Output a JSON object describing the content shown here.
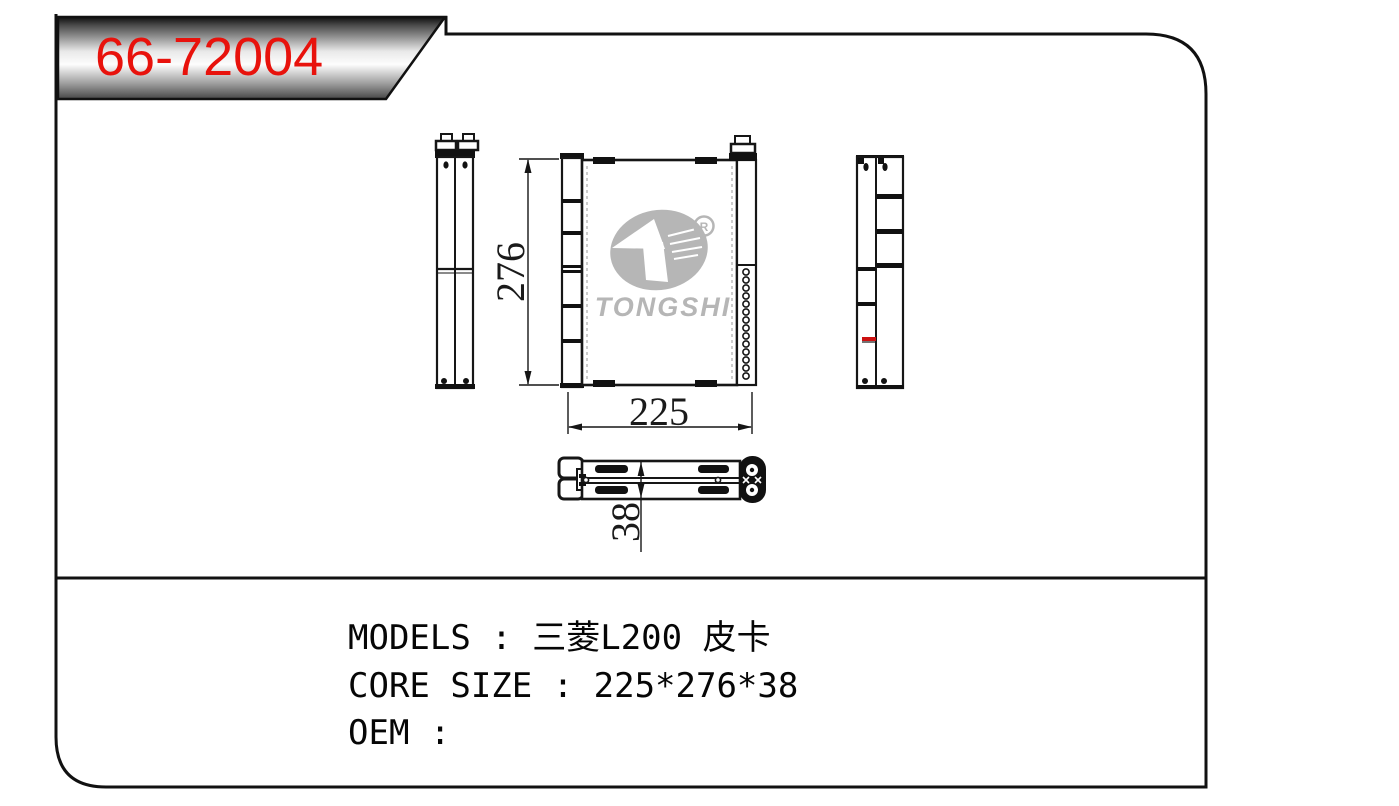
{
  "badge": {
    "part_number": "66-72004"
  },
  "logo": {
    "wordmark": "TONGSHI",
    "registered": "R"
  },
  "dimensions": {
    "core_height": "276",
    "core_width": "225",
    "core_depth": "38"
  },
  "specs": {
    "models": "MODELS : 三菱L200 皮卡",
    "core_size": "CORE SIZE : 225*276*38",
    "oem": "OEM :"
  },
  "colors": {
    "part_number_red": "#e8120c",
    "line_black": "#111111",
    "logo_gray": "#b6b6b6",
    "highlight_red": "#cc1111"
  }
}
